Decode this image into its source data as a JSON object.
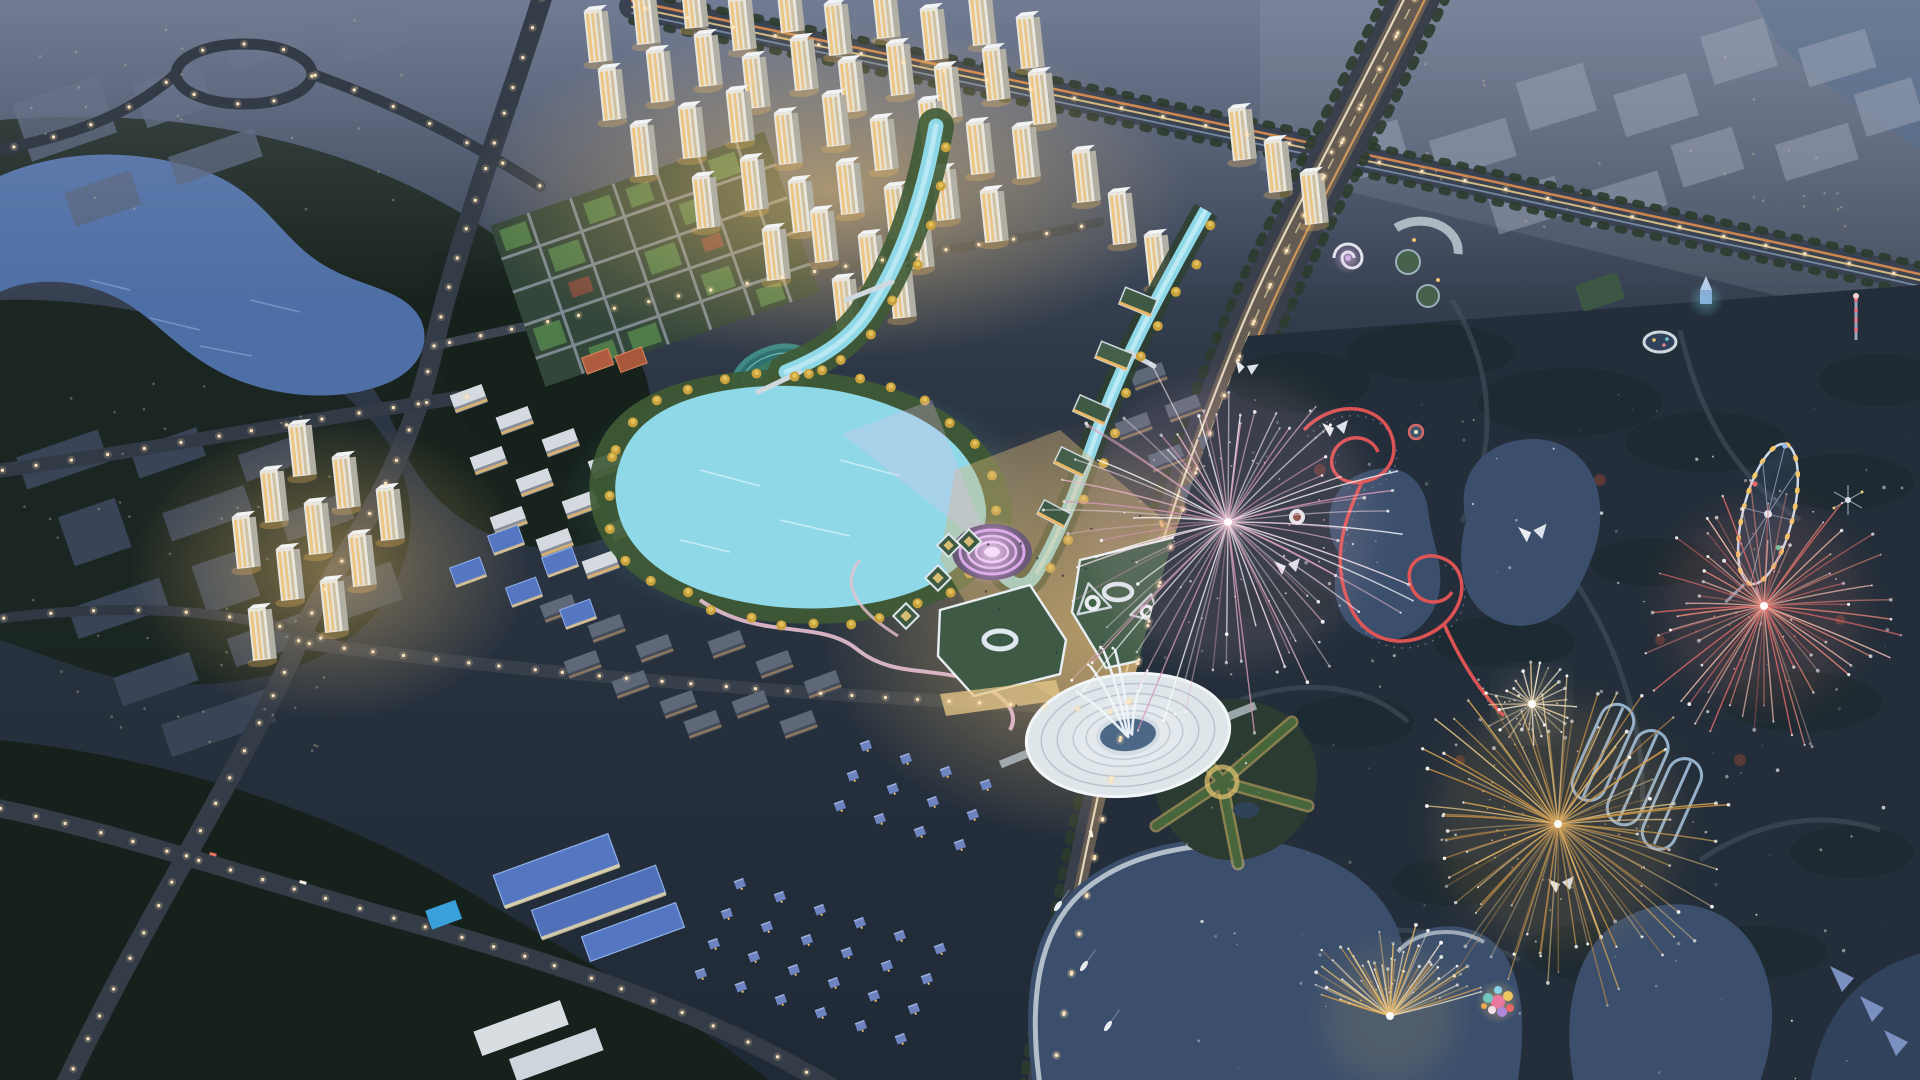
{
  "scene": {
    "description": "aerial-dusk-rendering-of-riverfront-masterplan-with-theme-park-and-fireworks",
    "time_of_day": "dusk",
    "view": "aerial-oblique"
  },
  "colors": {
    "base_ground": "#242e3c",
    "forest": "#17211b",
    "haze": "#9aa4b8",
    "lake": "#4e6fa5",
    "sea_corner": "#3e5574",
    "river": "#8fd8e8",
    "river_highlight": "#c8f0f8",
    "bank_green": "#3f5a35",
    "autumn_tree": "#c9a23e",
    "road": "#343c48",
    "avenue_glow": "#c89a5f",
    "street_light": "#ffd9a0",
    "tower_face": "#e9e6dd",
    "window_warm": "#f0c070",
    "green_roof": "#3e5a45",
    "maze_green": "#33463a",
    "track_teal": "#2e6f72",
    "amphitheater_pink": "#d9a8e8",
    "plaza_warm": "#d9b878",
    "fountain_deck": "#dfe6ea",
    "fountain_pool": "#2e4e72",
    "park_ground": "#232e3a",
    "park_lake": "#3b4f6c",
    "coaster_red": "#e85555",
    "coaster_blue": "#a8c8e8",
    "ferris_light": "#f5c868",
    "firework_pink": "#e8b8cc",
    "firework_gold": "#d9a855",
    "firework_coral": "#e88878",
    "firework_white": "#fff2d8"
  },
  "features": {
    "fireworks_bursts": 5,
    "boats": 3,
    "landmarks": [
      "central-river",
      "lakeside-amphitheater",
      "fountain-plaza",
      "residential-towers",
      "theme-park",
      "ferris-wheel",
      "red-roller-coaster",
      "running-track",
      "highway",
      "forest-lake"
    ]
  }
}
